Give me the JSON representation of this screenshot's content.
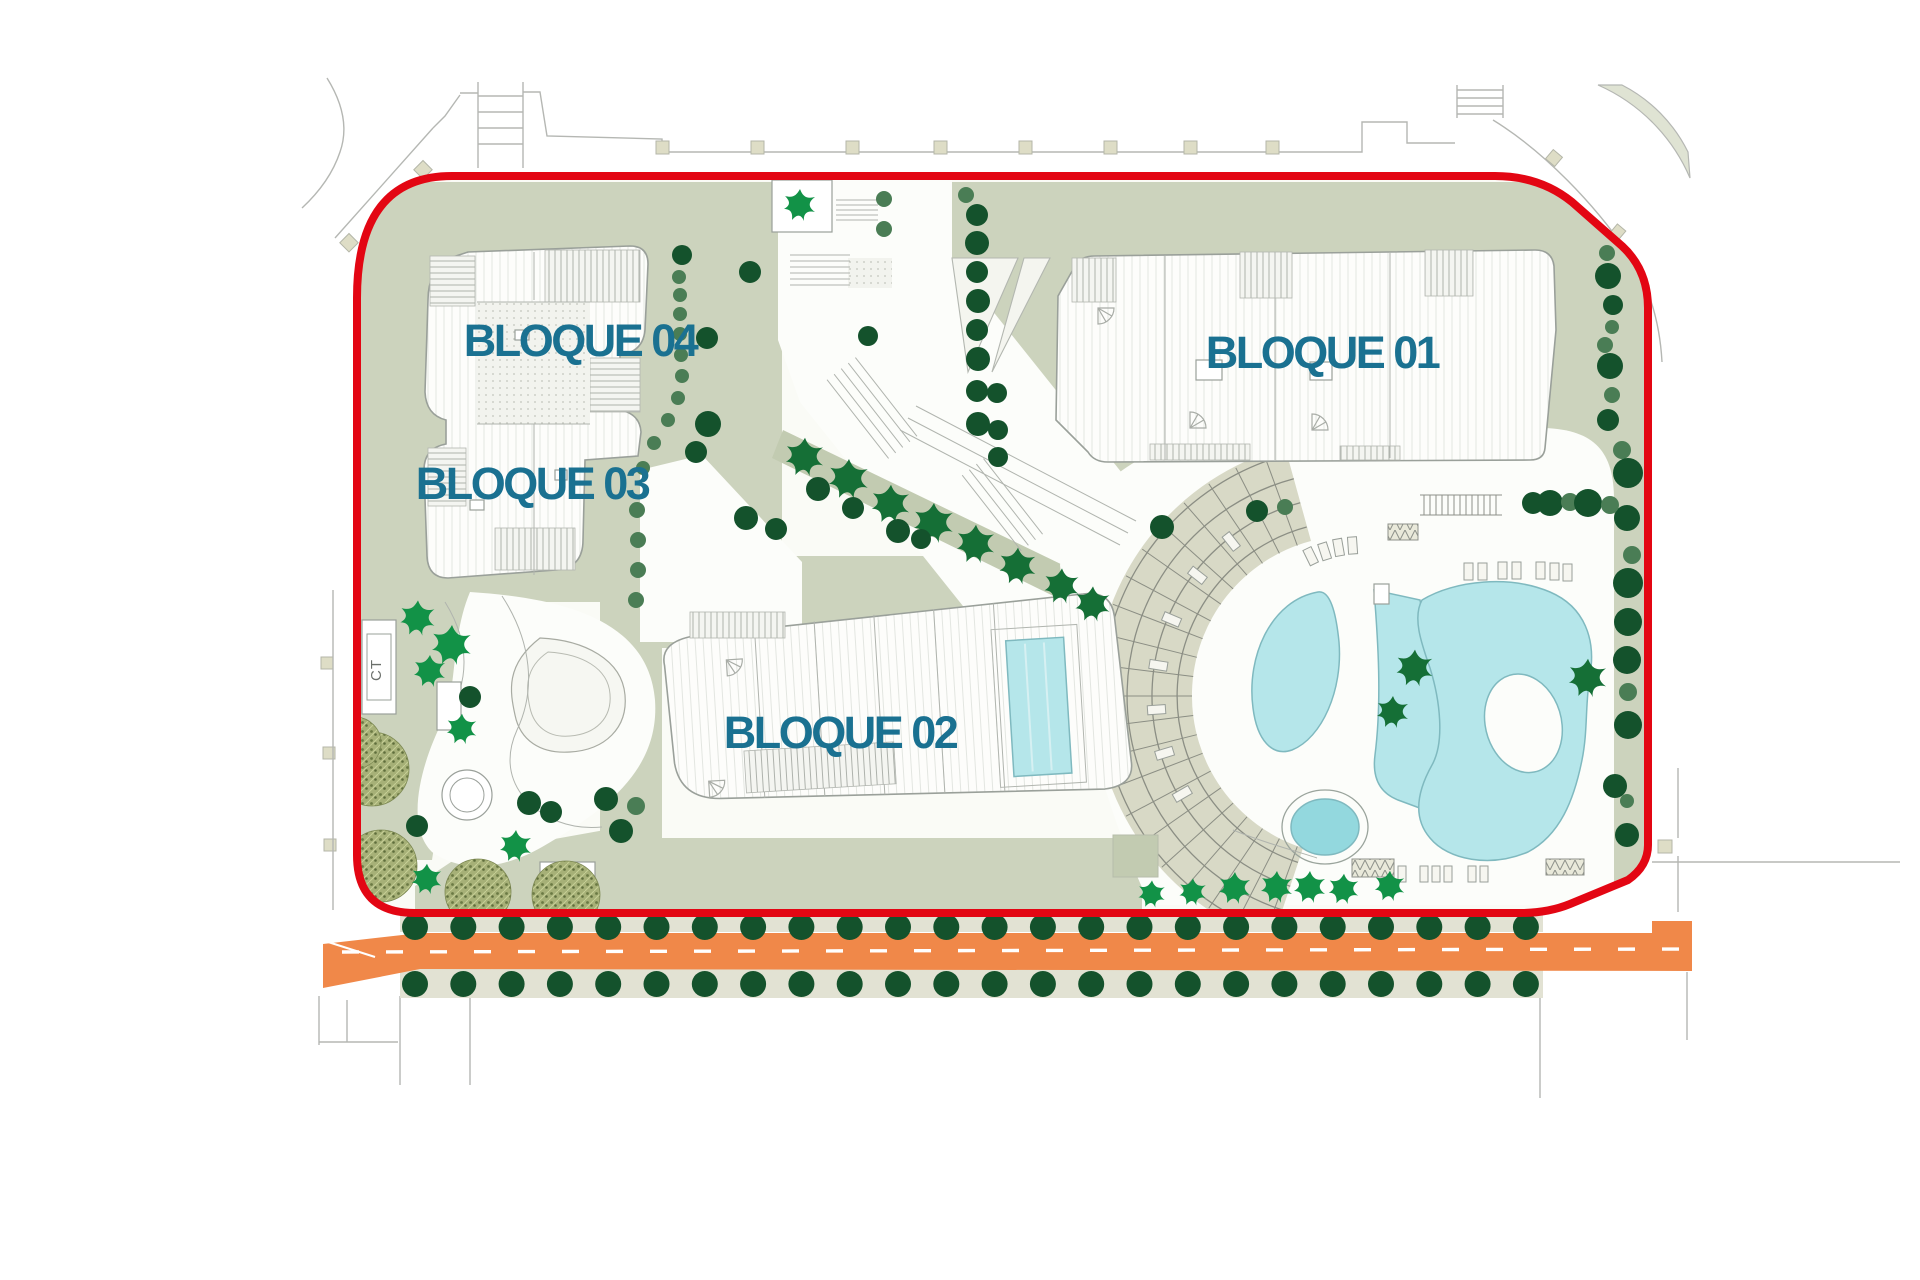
{
  "labels": {
    "bloque01": "BLOQUE 01",
    "bloque02": "BLOQUE 02",
    "bloque03": "BLOQUE 03",
    "bloque04": "BLOQUE 04",
    "ct": "CT"
  },
  "colors": {
    "red": "#e30613",
    "label_blue": "#1a7191",
    "pool": "#b5e6ea",
    "pool_dk": "#93d8de",
    "pool_edge": "#7fb9bf",
    "road": "#f08849",
    "sage": "#ccd3bd",
    "sage_dark": "#c2cbb1",
    "deck": "#dfe0d0",
    "band": "#d8d9c6",
    "sidewalk": "#e2e2d3",
    "tree_dark": "#14522c",
    "tree_med": "#4a7d55",
    "palm_bright": "#129247",
    "palm_dark": "#156f36",
    "ctx": "#b5b7b3",
    "bstroke": "#9aa09a"
  },
  "street_trees": {
    "trees_per_row": 24,
    "start_x": 415,
    "step_x": 48.3,
    "top_row_y": 927,
    "bottom_row_y": 984,
    "radius": 13
  }
}
